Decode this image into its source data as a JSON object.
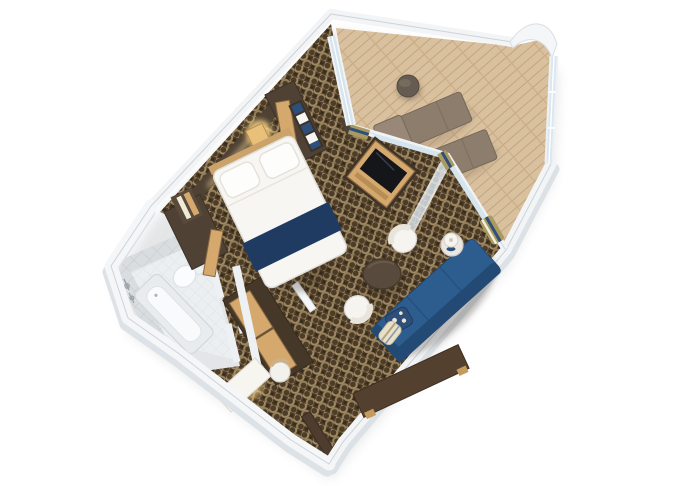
{
  "scene": {
    "type": "3d-floor-plan",
    "subject": "cruise-ship one-bedroom suite with private balcony, rendered in tilted top-down 3D view on white background",
    "orientation": "suite rotated diagonally; bathroom lower-left, bedroom center-left, living room center-right, balcony top-right"
  },
  "palette": {
    "wall": "#f2f4f6",
    "wall_edge": "#ccd3d9",
    "wall_side": "#dde2e7",
    "carpet_bg": "#4c3c28",
    "carpet_link": "#a08a63",
    "carpet_dark": "#2f2416",
    "deck": "#d9c09e",
    "deck_line": "#c2a67e",
    "tile": "#d9dde0",
    "tile_line": "#c3c9ce",
    "bath_floor": "#eceff1",
    "dark_wood": "#4f4134",
    "wood_tan": "#d5a96d",
    "wood_tan_dark": "#8a6a42",
    "navy": "#1f3b61",
    "sofa_blue": "#2d5d8f",
    "sofa_blue_dark": "#234a74",
    "white_fabric": "#f7f6f3",
    "lounger": "#8d7d6c",
    "lounger_dark": "#76685a",
    "table_dark": "#584a3c",
    "glass": "#d6e4ee",
    "glass_frame": "#fafcfd",
    "curtain_gold": "#a99a5f",
    "curtain_navy": "#2e4f7a",
    "glow": "#ffd98a",
    "screen_black": "#15161a"
  },
  "rooms": {
    "bathroom": {
      "name": "bathroom",
      "floor": "white tile",
      "items": [
        "bathtub",
        "toilet",
        "shower fixtures",
        "door"
      ]
    },
    "bedroom": {
      "name": "bedroom",
      "floor": "patterned brown carpet",
      "items": [
        "double bed with navy runner",
        "two pillows",
        "headboard wall with lights",
        "wardrobe with open tan door",
        "shelves with towels",
        "lit nightstand",
        "vanity desk with stool",
        "window to balcony"
      ]
    },
    "living_room": {
      "name": "living room",
      "floor": "patterned brown carpet",
      "items": [
        "blue sofa with two pillows",
        "round coffee table",
        "two white barrel chairs",
        "console table",
        "side table with lamp",
        "TV cabinet",
        "curtains",
        "open glass balcony door",
        "entry door"
      ]
    },
    "balcony": {
      "name": "balcony",
      "floor": "wood plank decking",
      "items": [
        "two loungers",
        "round table",
        "glass railing",
        "curved hull wall"
      ]
    }
  }
}
